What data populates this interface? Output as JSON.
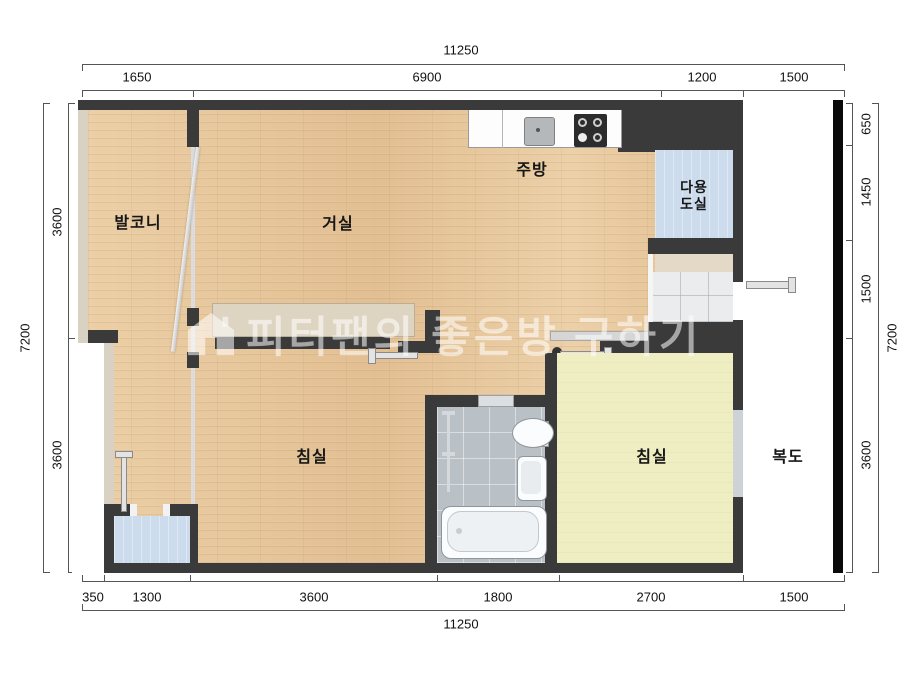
{
  "watermark": {
    "text": "피터팬의 좋은방 구하기",
    "icon": "house-icon",
    "color": "#ffffff"
  },
  "rooms": {
    "balcony": {
      "label": "발코니"
    },
    "living": {
      "label": "거실"
    },
    "kitchen": {
      "label": "주방"
    },
    "utility": {
      "label": "다용도실",
      "line1": "다용",
      "line2": "도실"
    },
    "bedroom_left": {
      "label": "침실"
    },
    "bedroom_right": {
      "label": "침실"
    },
    "corridor": {
      "label": "복도"
    }
  },
  "dimensions": {
    "top": {
      "total": "11250",
      "segments": [
        "1650",
        "6900",
        "1200",
        "1500"
      ]
    },
    "bottom": {
      "total": "11250",
      "segments": [
        "350",
        "1300",
        "3600",
        "1800",
        "2700",
        "1500"
      ]
    },
    "left": {
      "total": "7200",
      "segments": [
        "3600",
        "3600"
      ]
    },
    "right": {
      "total": "7200",
      "segments": [
        "650",
        "1450",
        "1500",
        "3600"
      ]
    }
  },
  "colors": {
    "wall": "#3a3a3a",
    "light_wall": "#d9d1c1",
    "wood_floor": "#e8c79d",
    "yellow_floor": "#efeec2",
    "blue_floor": "#ccdcec",
    "bath_tile": "#bac1c6",
    "corridor_bar": "#000000"
  }
}
